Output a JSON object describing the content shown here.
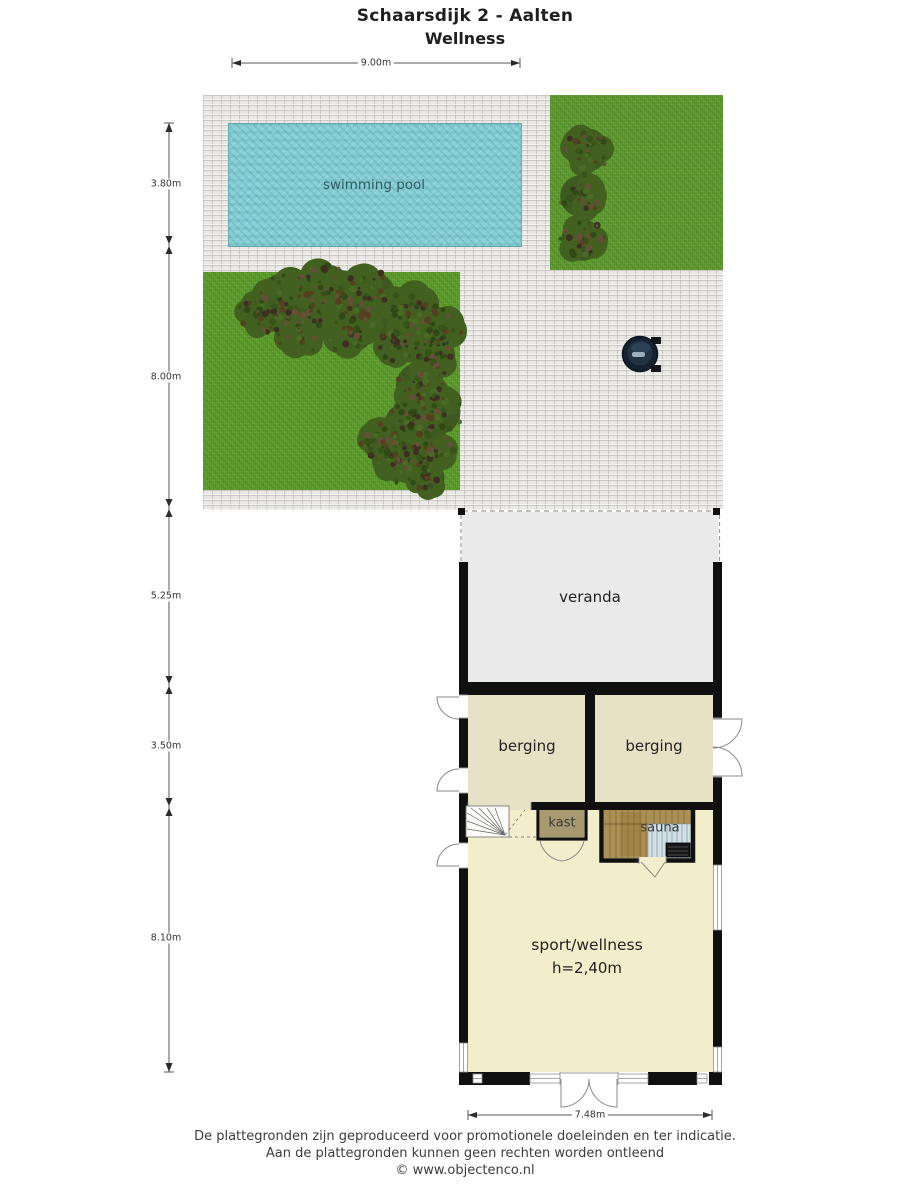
{
  "title": {
    "line1": "Schaarsdijk 2 - Aalten",
    "line2": "Wellness"
  },
  "dimensions": {
    "top": "9.00m",
    "left": [
      "3.80m",
      "8.00m",
      "5.25m",
      "3.50m",
      "8.10m"
    ],
    "bottom": "7.48m"
  },
  "labels": {
    "pool": "swimming pool",
    "veranda": "veranda",
    "berging_left": "berging",
    "berging_right": "berging",
    "kast": "kast",
    "sauna": "sauna",
    "sport": "sport/wellness",
    "sport_height": "h=2,40m"
  },
  "footer": {
    "line1": "De plattegronden zijn geproduceerd voor promotionele doeleinden en ter indicatie.",
    "line2": "Aan de plattegronden kunnen geen rechten worden ontleend",
    "line3": "© www.objectenco.nl"
  },
  "colors": {
    "paving": "#e9e8e5",
    "grass": "#5f9e2e",
    "pool": "#86ced4",
    "veranda_floor": "#eaeaea",
    "berging_floor": "#e7e1c5",
    "sport_floor": "#f2edca",
    "kast_floor": "#a89a70",
    "sauna_wood": "#ac9055",
    "sauna_bench": "#d2e0e6",
    "wall": "#101010",
    "hot_tub": "#15212e"
  }
}
